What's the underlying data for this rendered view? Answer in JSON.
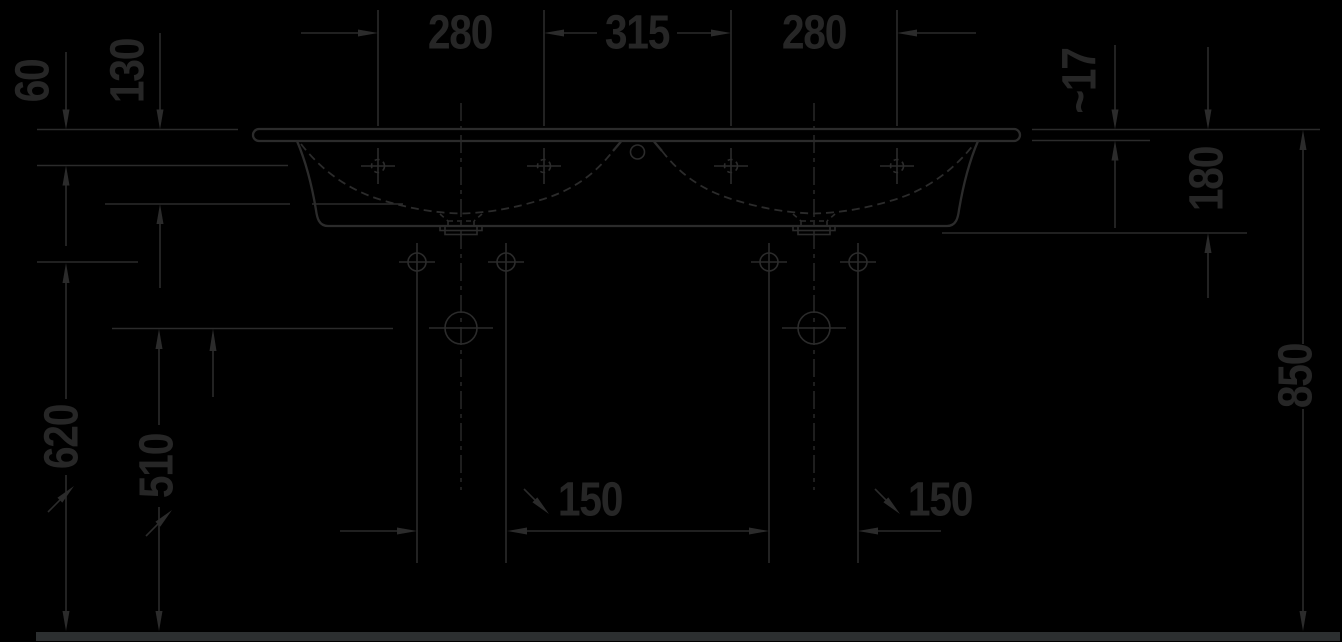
{
  "drawing": {
    "type": "technical-dimension-drawing",
    "view": "double-washbasin-front-elevation"
  },
  "colors": {
    "background": "#000000",
    "stroke": "#2b2b2b",
    "text": "#262626",
    "floor_bar": "#2c2f30"
  },
  "dimensions": {
    "top": {
      "left": "280",
      "center": "315",
      "right": "280"
    },
    "left": {
      "rim_to_taphole": "60",
      "bowl_depth": "130",
      "floor_to_fixing_holes": "620",
      "floor_to_siphon": "510"
    },
    "right": {
      "rim_thickness": "~17",
      "rim_to_underside": "180",
      "floor_to_rim": "850"
    },
    "bottom": {
      "left_drain_offset": "150",
      "right_drain_offset": "150"
    }
  }
}
